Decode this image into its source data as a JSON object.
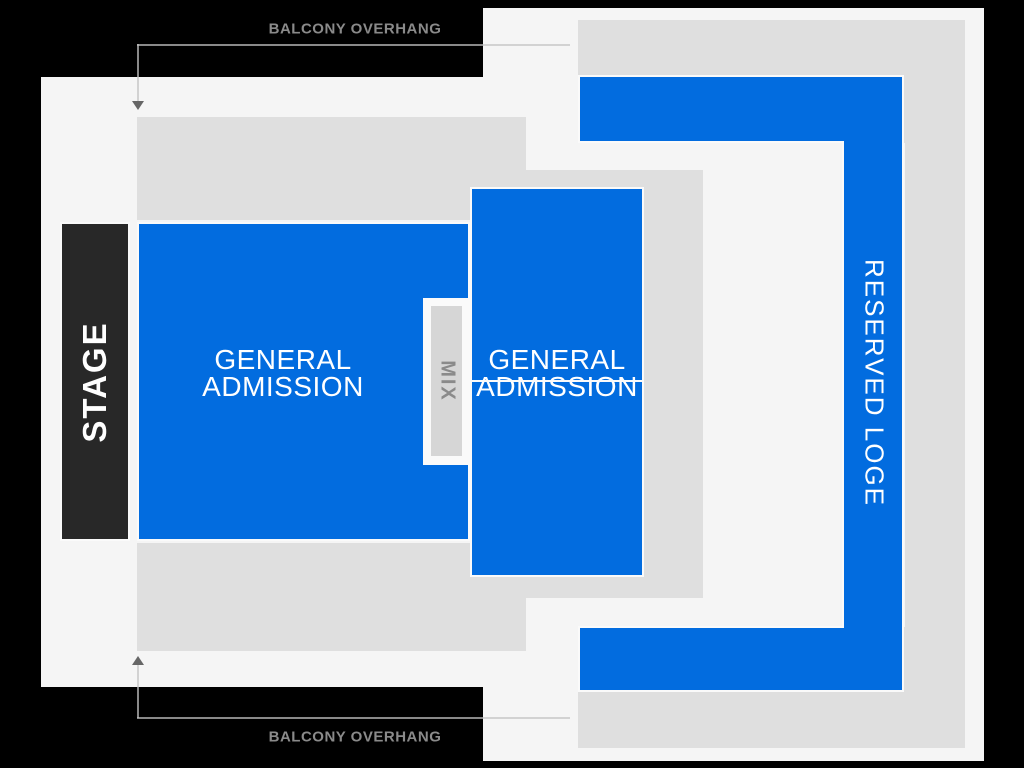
{
  "map": {
    "stage": {
      "label": "STAGE"
    },
    "sections": {
      "ga_main": {
        "line1": "GENERAL",
        "line2": "ADMISSION"
      },
      "ga_right": {
        "line1": "GENERAL",
        "line2": "ADMISSION"
      },
      "reserved_loge": {
        "label": "RESERVED LOGE"
      },
      "mix": {
        "label": "MIX"
      }
    },
    "annotations": {
      "top": {
        "label": "BALCONY OVERHANG"
      },
      "bottom": {
        "label": "BALCONY OVERHANG"
      }
    }
  },
  "colors": {
    "background": "#000000",
    "floor": "#F5F5F5",
    "overhang": "#DFDFDF",
    "section_blue": "#026CDF",
    "stage_fill": "#282828",
    "stroke_white": "#FAFAFA",
    "mix_inner": "#D6D6D6",
    "label_gray": "#8A8A8A",
    "arrow_gray": "#666666"
  }
}
